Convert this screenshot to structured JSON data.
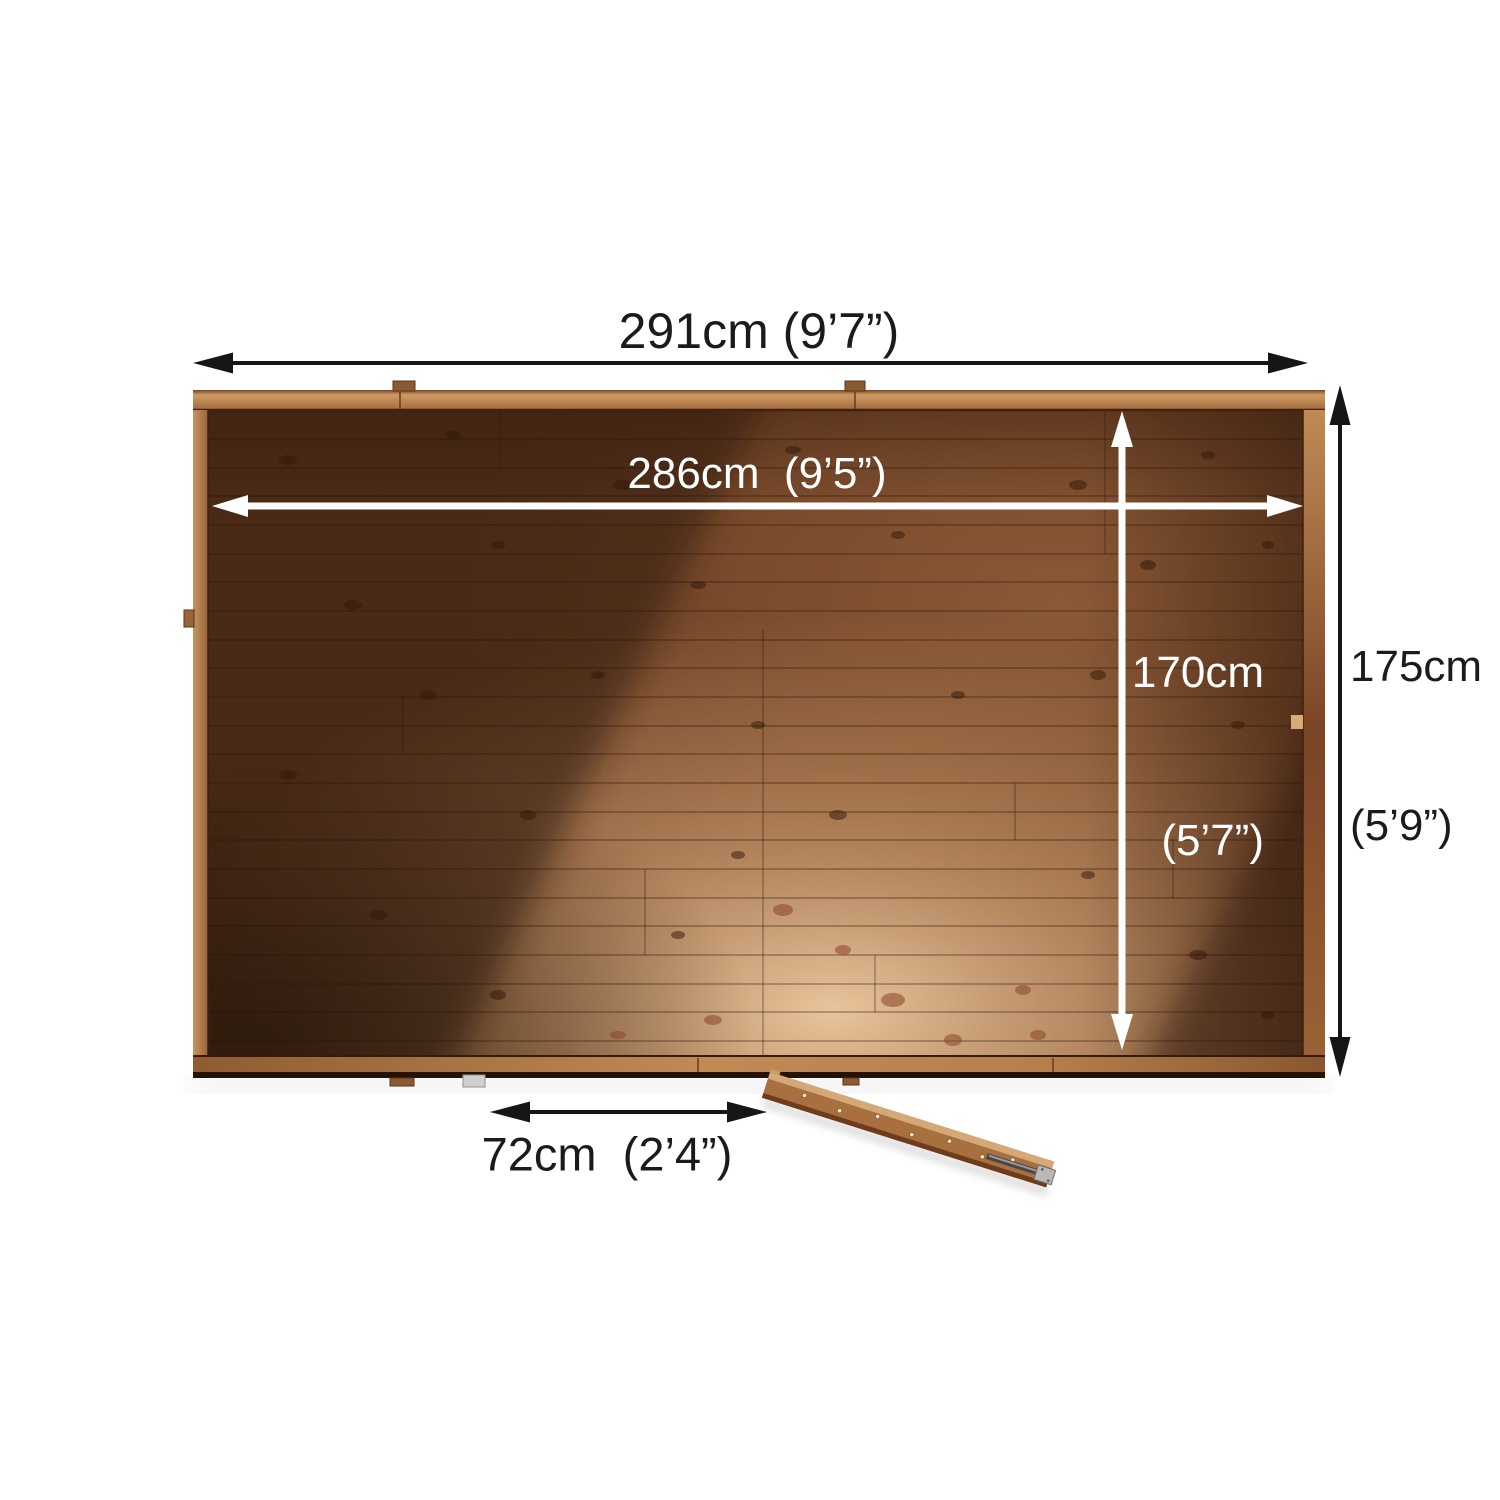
{
  "diagram": {
    "labels": {
      "outer_width": "291cm (9’7”)",
      "inner_width": "286cm  (9’5”)",
      "outer_depth_line1": "175cm",
      "outer_depth_line2": "(5’9”)",
      "inner_depth_line1": "170cm",
      "inner_depth_line2": "(5’7”)",
      "door_width": "72cm  (2’4”)"
    },
    "colors": {
      "background": "#ffffff",
      "arrow_dark": "#161616",
      "arrow_light": "#ffffff",
      "label_dark": "#1b1b1b",
      "label_light": "#ffffff",
      "wood_frame": "#bb8551",
      "wood_dark": "#56301b",
      "wood_beam_highlight": "#e9c49e",
      "metal_grey": "#b9b9b9"
    }
  }
}
